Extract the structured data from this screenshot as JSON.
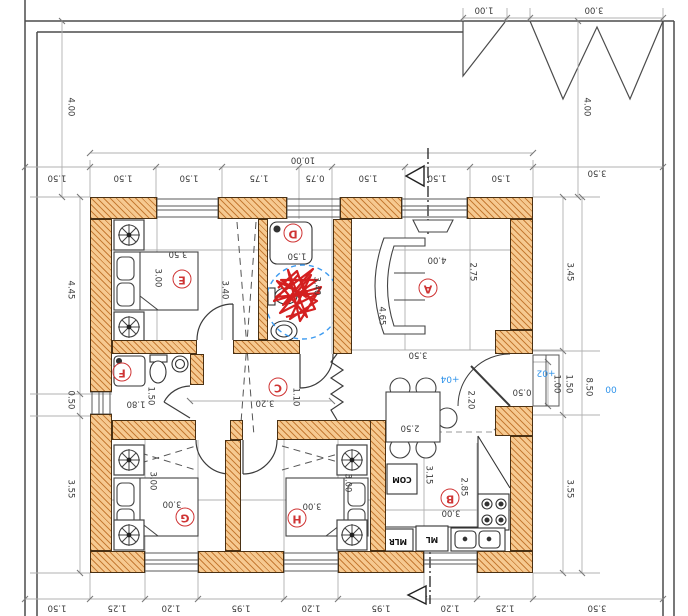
{
  "drawing": {
    "kind": "architectural floor plan (rotated 180°)",
    "total_width_label": "10.00",
    "total_height_label": "8.50"
  },
  "colors": {
    "wall_fill": "#f6c990",
    "wall_hatch": "#bd6e25",
    "line": "#3a3a3a",
    "gray": "#b0b0b0",
    "room_label_red": "#cf3434",
    "level_blue": "#2f93ea",
    "marker_red": "#d42020",
    "marker_blue_dashed": "#3e9bf0"
  },
  "rooms": [
    {
      "t": "A",
      "x": 428,
      "y": 288
    },
    {
      "t": "B",
      "x": 450,
      "y": 498
    },
    {
      "t": "C",
      "x": 278,
      "y": 387
    },
    {
      "t": "D",
      "x": 293,
      "y": 233
    },
    {
      "t": "E",
      "x": 182,
      "y": 279
    },
    {
      "t": "F",
      "x": 122,
      "y": 372
    },
    {
      "t": "G",
      "x": 185,
      "y": 517
    },
    {
      "t": "H",
      "x": 297,
      "y": 518
    }
  ],
  "dims_h": [
    {
      "t": "1.00",
      "x": 484,
      "y": 9
    },
    {
      "t": "3.00",
      "x": 594,
      "y": 9
    },
    {
      "t": "10.00",
      "x": 303,
      "y": 159
    },
    {
      "t": "1.50",
      "x": 57,
      "y": 177
    },
    {
      "t": "1.50",
      "x": 123,
      "y": 177
    },
    {
      "t": "1.50",
      "x": 189,
      "y": 177
    },
    {
      "t": "1.75",
      "x": 259,
      "y": 177
    },
    {
      "t": "0.75",
      "x": 315,
      "y": 177
    },
    {
      "t": "1.50",
      "x": 368,
      "y": 177
    },
    {
      "t": "1.50",
      "x": 437,
      "y": 177
    },
    {
      "t": "1.50",
      "x": 501,
      "y": 177
    },
    {
      "t": "3.50",
      "x": 597,
      "y": 172
    },
    {
      "t": "3.50",
      "x": 178,
      "y": 253
    },
    {
      "t": "1.50",
      "x": 297,
      "y": 255
    },
    {
      "t": "4.00",
      "x": 437,
      "y": 259
    },
    {
      "t": "3.50",
      "x": 418,
      "y": 354
    },
    {
      "t": "3.20",
      "x": 265,
      "y": 402
    },
    {
      "t": "1.80",
      "x": 136,
      "y": 403
    },
    {
      "t": "0.50",
      "x": 522,
      "y": 391
    },
    {
      "t": "2.50",
      "x": 410,
      "y": 427
    },
    {
      "t": "3.00",
      "x": 172,
      "y": 503
    },
    {
      "t": "3.00",
      "x": 312,
      "y": 505
    },
    {
      "t": "3.00",
      "x": 451,
      "y": 512
    },
    {
      "t": "1.50",
      "x": 57,
      "y": 607
    },
    {
      "t": "1.25",
      "x": 117,
      "y": 607
    },
    {
      "t": "1.20",
      "x": 171,
      "y": 607
    },
    {
      "t": "1.95",
      "x": 241,
      "y": 607
    },
    {
      "t": "1.20",
      "x": 311,
      "y": 607
    },
    {
      "t": "1.95",
      "x": 381,
      "y": 607
    },
    {
      "t": "1.20",
      "x": 450,
      "y": 607
    },
    {
      "t": "1.25",
      "x": 505,
      "y": 607
    },
    {
      "t": "3.50",
      "x": 597,
      "y": 607
    }
  ],
  "dims_v": [
    {
      "t": "4.00",
      "x": 70,
      "y": 107
    },
    {
      "t": "4.45",
      "x": 70,
      "y": 290
    },
    {
      "t": "0.50",
      "x": 70,
      "y": 400
    },
    {
      "t": "3.55",
      "x": 70,
      "y": 489
    },
    {
      "t": "4.00",
      "x": 586,
      "y": 107
    },
    {
      "t": "3.45",
      "x": 569,
      "y": 272
    },
    {
      "t": "1.00",
      "x": 556,
      "y": 384
    },
    {
      "t": "1.50",
      "x": 568,
      "y": 384
    },
    {
      "t": "8.50",
      "x": 588,
      "y": 387
    },
    {
      "t": "3.55",
      "x": 569,
      "y": 489
    },
    {
      "t": "3.00",
      "x": 157,
      "y": 278
    },
    {
      "t": "3.40",
      "x": 224,
      "y": 290
    },
    {
      "t": "3.40",
      "x": 316,
      "y": 286
    },
    {
      "t": "1.50",
      "x": 150,
      "y": 396
    },
    {
      "t": "1.10",
      "x": 295,
      "y": 397
    },
    {
      "t": "3.00",
      "x": 152,
      "y": 481
    },
    {
      "t": "3.00",
      "x": 347,
      "y": 483
    },
    {
      "t": "3.15",
      "x": 428,
      "y": 475
    },
    {
      "t": "2.85",
      "x": 463,
      "y": 487
    },
    {
      "t": "2.75",
      "x": 472,
      "y": 272
    },
    {
      "t": "4.65",
      "x": 381,
      "y": 316
    },
    {
      "t": "2.20",
      "x": 470,
      "y": 400
    }
  ],
  "levels": [
    {
      "t": "+04",
      "x": 450,
      "y": 378
    },
    {
      "t": "+02",
      "x": 546,
      "y": 372
    },
    {
      "t": "00",
      "x": 611,
      "y": 388
    }
  ],
  "appliances": [
    {
      "t": "COM",
      "x": 402,
      "y": 479
    },
    {
      "t": "MLR",
      "x": 398,
      "y": 541
    },
    {
      "t": "ML",
      "x": 432,
      "y": 539
    }
  ]
}
